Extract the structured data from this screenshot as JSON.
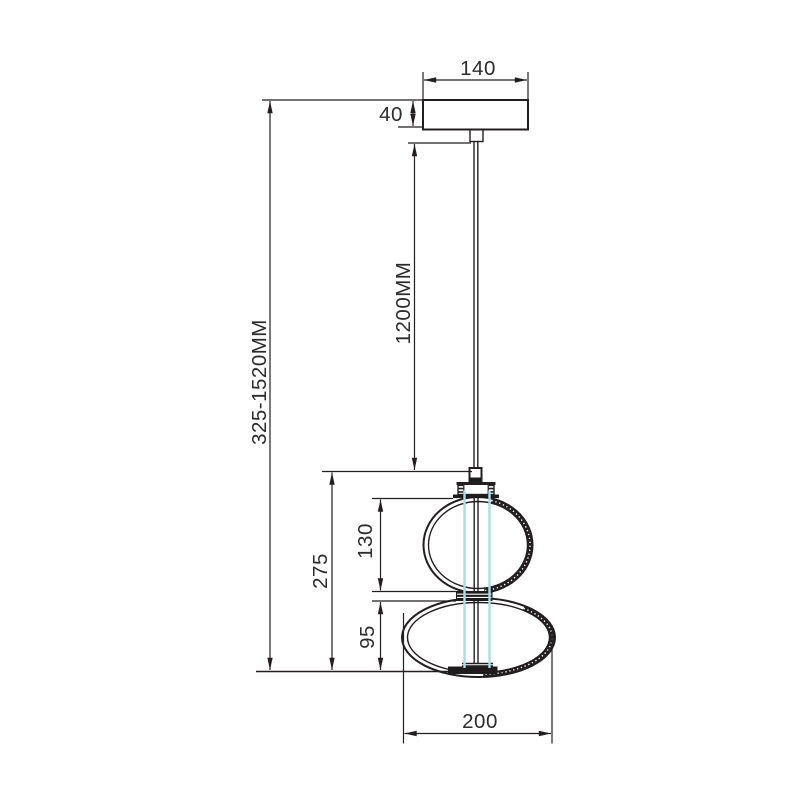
{
  "drawing": {
    "dims": {
      "canopy_width": "140",
      "canopy_height": "40",
      "overall_height": "325-1520MM",
      "cord_length": "1200MM",
      "shade_height": "275",
      "upper_globe_height": "130",
      "lower_globe_height": "95",
      "shade_width": "200"
    },
    "colors": {
      "line": "#231f20",
      "text": "#2c2c2c",
      "led_tube": "#aadcee",
      "background": "#ffffff"
    }
  }
}
